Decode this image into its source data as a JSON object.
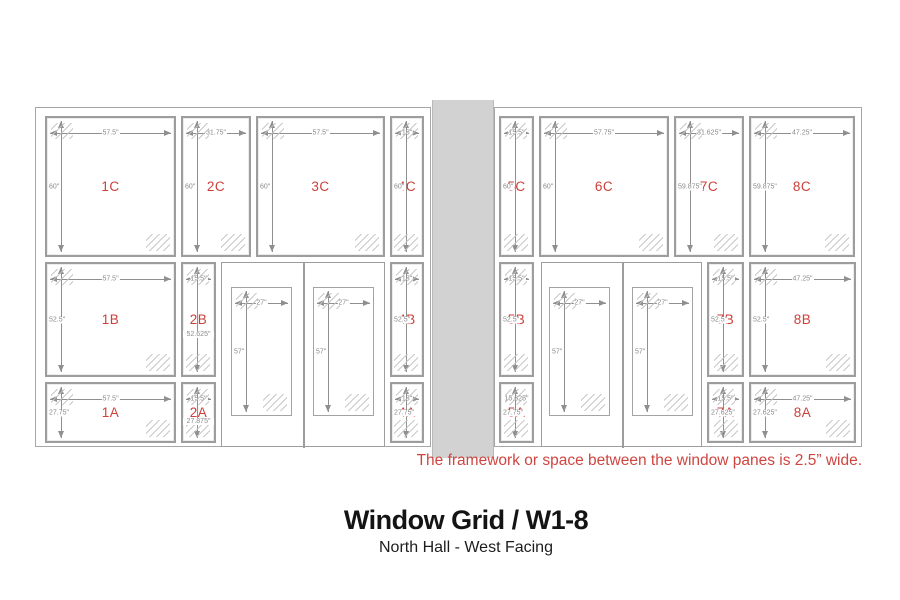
{
  "title": "Window Grid / W1-8",
  "subtitle": "North Hall - West Facing",
  "note": "The framework or space between the window panes is 2.5” wide.",
  "colors": {
    "label_red": "#cc403a",
    "note_red": "#cf4540",
    "dim_gray": "#8f8f8f",
    "pane_border": "#9d9d9d",
    "wall_gray": "#d2d2d2"
  },
  "diagram": {
    "frames": [
      {
        "id": "left-wall-frame",
        "x": 35,
        "y": 107,
        "w": 396,
        "h": 340
      },
      {
        "id": "right-wall-frame",
        "x": 494,
        "y": 107,
        "w": 368,
        "h": 340
      }
    ],
    "wall_divider": {
      "id": "wall-divider",
      "x": 432,
      "y": 100,
      "w": 62,
      "h": 358
    },
    "doors": [
      {
        "id": "left-double-door",
        "x": 221,
        "y": 262,
        "w": 164,
        "h": 185,
        "divider_x": 81
      },
      {
        "id": "right-double-door",
        "x": 541,
        "y": 262,
        "w": 161,
        "h": 185,
        "divider_x": 80
      }
    ],
    "windows": [
      {
        "name": "1C",
        "x": 45,
        "y": 116,
        "w": 131,
        "h": 141,
        "width_label": "57.5\"",
        "height_label": "60\"",
        "hpos": "left"
      },
      {
        "name": "2C",
        "x": 181,
        "y": 116,
        "w": 70,
        "h": 141,
        "width_label": "31.75\"",
        "height_label": "60\"",
        "hpos": "left"
      },
      {
        "name": "3C",
        "x": 256,
        "y": 116,
        "w": 129,
        "h": 141,
        "width_label": "57.5\"",
        "height_label": "60\"",
        "hpos": "left"
      },
      {
        "name": "4C",
        "x": 390,
        "y": 116,
        "w": 34,
        "h": 141,
        "width_label": "15\"",
        "height_label": "60\"",
        "hpos": "left"
      },
      {
        "name": "5C",
        "x": 499,
        "y": 116,
        "w": 35,
        "h": 141,
        "width_label": "15.5\"",
        "height_label": "60\"",
        "hpos": "left"
      },
      {
        "name": "6C",
        "x": 539,
        "y": 116,
        "w": 130,
        "h": 141,
        "width_label": "57.75\"",
        "height_label": "60\"",
        "hpos": "left"
      },
      {
        "name": "7C",
        "x": 674,
        "y": 116,
        "w": 70,
        "h": 141,
        "width_label": "31.625\"",
        "height_label": "59.875\"",
        "hpos": "left"
      },
      {
        "name": "8C",
        "x": 749,
        "y": 116,
        "w": 106,
        "h": 141,
        "width_label": "47.25\"",
        "height_label": "59.875\"",
        "hpos": "left"
      },
      {
        "name": "1B",
        "x": 45,
        "y": 262,
        "w": 131,
        "h": 115,
        "width_label": "57.5\"",
        "height_label": "52.5\"",
        "hpos": "left"
      },
      {
        "name": "2B",
        "x": 181,
        "y": 262,
        "w": 35,
        "h": 115,
        "width_label": "15.5\"",
        "height_label": "52.625\"",
        "hpos": "below"
      },
      {
        "name": "4B",
        "x": 390,
        "y": 262,
        "w": 34,
        "h": 115,
        "width_label": "15\"",
        "height_label": "52.5\"",
        "hpos": "left"
      },
      {
        "name": "5B",
        "x": 499,
        "y": 262,
        "w": 35,
        "h": 115,
        "width_label": "15.5\"",
        "height_label": "52.5\"",
        "hpos": "left"
      },
      {
        "name": "7B",
        "x": 707,
        "y": 262,
        "w": 37,
        "h": 115,
        "width_label": "15.5\"",
        "height_label": "52.5\"",
        "hpos": "left"
      },
      {
        "name": "8B",
        "x": 749,
        "y": 262,
        "w": 107,
        "h": 115,
        "width_label": "47.25\"",
        "height_label": "52.5\"",
        "hpos": "left"
      },
      {
        "name": "1A",
        "x": 45,
        "y": 382,
        "w": 131,
        "h": 61,
        "width_label": "57.5\"",
        "height_label": "27.75\"",
        "hpos": "left"
      },
      {
        "name": "2A",
        "x": 181,
        "y": 382,
        "w": 35,
        "h": 61,
        "width_label": "15.5\"",
        "height_label": "27.875\"",
        "hpos": "below"
      },
      {
        "name": "4A",
        "x": 390,
        "y": 382,
        "w": 34,
        "h": 61,
        "width_label": "15\"",
        "height_label": "27.75\"",
        "hpos": "left"
      },
      {
        "name": "5A",
        "x": 499,
        "y": 382,
        "w": 35,
        "h": 61,
        "width_label": "15.625\"",
        "height_label": "27.75\"",
        "hpos": "left"
      },
      {
        "name": "7A",
        "x": 707,
        "y": 382,
        "w": 37,
        "h": 61,
        "width_label": "15.5\"",
        "height_label": "27.625\"",
        "hpos": "left"
      },
      {
        "name": "8A",
        "x": 749,
        "y": 382,
        "w": 107,
        "h": 61,
        "width_label": "47.25\"",
        "height_label": "27.625\"",
        "hpos": "left"
      }
    ],
    "door_glass": [
      {
        "id": "left-door-glass-1",
        "x": 231,
        "y": 287,
        "w": 61,
        "h": 129,
        "width_label": "27\"",
        "height_label": "57\""
      },
      {
        "id": "left-door-glass-2",
        "x": 313,
        "y": 287,
        "w": 61,
        "h": 129,
        "width_label": "27\"",
        "height_label": "57\""
      },
      {
        "id": "right-door-glass-1",
        "x": 549,
        "y": 287,
        "w": 61,
        "h": 129,
        "width_label": "27\"",
        "height_label": "57\""
      },
      {
        "id": "right-door-glass-2",
        "x": 632,
        "y": 287,
        "w": 61,
        "h": 129,
        "width_label": "27\"",
        "height_label": "57\""
      }
    ]
  }
}
